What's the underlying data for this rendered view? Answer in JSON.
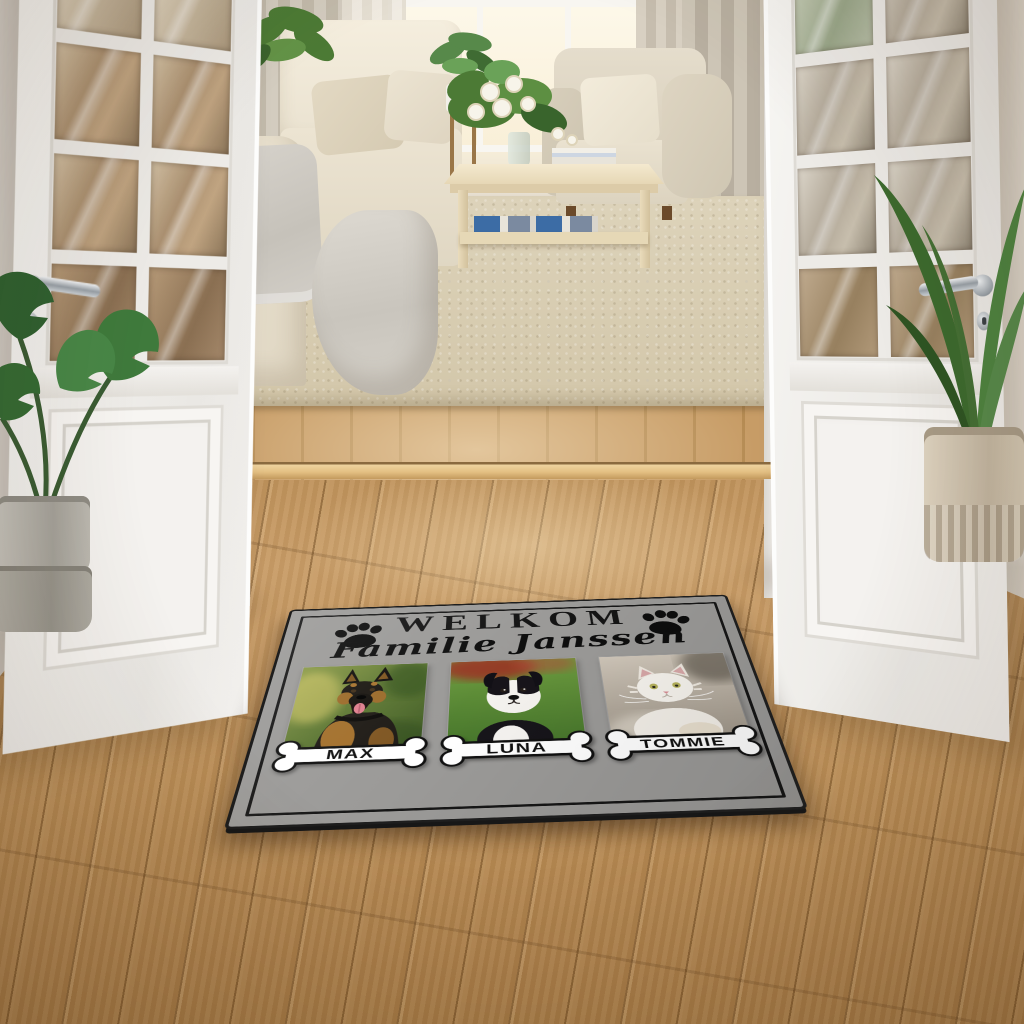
{
  "scene": {
    "subject": "personalized pet doormat lying on an oak hardwood floor",
    "setting": "open white french doors leading from a hallway into a beige living room"
  },
  "doormat": {
    "greeting": "WELKOM",
    "family_name": "Familie Janssen",
    "pets": [
      {
        "name": "MAX",
        "animal": "German Shepherd dog"
      },
      {
        "name": "LUNA",
        "animal": "Border Collie puppy"
      },
      {
        "name": "TOMMIE",
        "animal": "white Persian cat"
      }
    ],
    "decorations": [
      "paw-print-left",
      "paw-print-right"
    ],
    "name_plate_shape": "dog bone",
    "colors": {
      "mat": "#9b9a98",
      "border_line": "#161616",
      "rubber_edge": "#1e1e1e",
      "bone_fill": "#ffffff",
      "bone_outline": "#111111",
      "text": "#141414"
    }
  },
  "room": {
    "furniture": [
      "cream sofa with gray throw blanket and pillows",
      "beige armchair with cream pillow",
      "light wood coffee table with white flower bouquet, books and lower shelf",
      "white cabinet with glowing lamp",
      "wooden plant stand with potted plant"
    ],
    "plants": [
      "monstera in gray pot (hallway left)",
      "tall green plant in cream ribbed pot (hallway right)",
      "plant behind sofa",
      "white rose bouquet on coffee table"
    ],
    "textiles": [
      "beige area rug",
      "sheer white curtains",
      "gray-beige drapes"
    ],
    "doors": "white french doors with glass panes, chrome lever handles and keyholes",
    "colors": {
      "floor_light": "#c89c66",
      "floor_dark": "#a87c47",
      "wall": "#ece5da",
      "door": "#f5f3f0",
      "rug": "#d8cdb2",
      "sofa": "#ece4d2",
      "drapes": "#c6bdae",
      "lamp_glow": "#ffe9be",
      "threshold": "#e3bf82"
    }
  }
}
